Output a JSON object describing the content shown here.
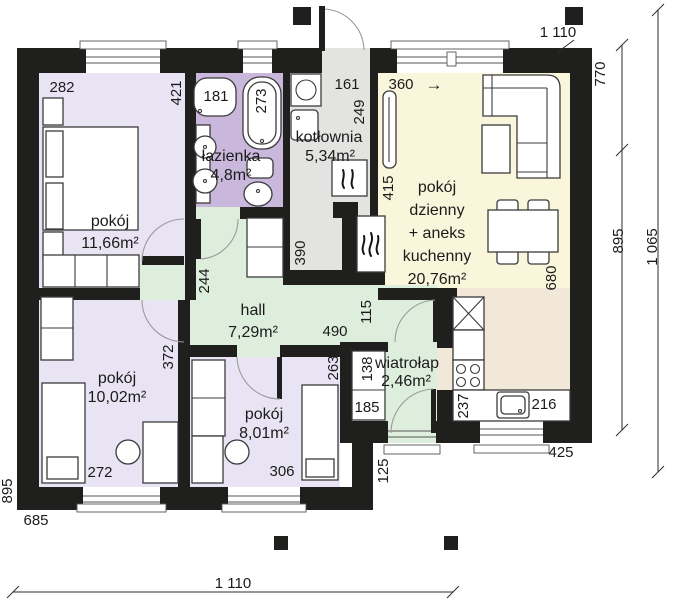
{
  "plan": {
    "rooms": {
      "pokoj1": {
        "label": "pokój",
        "area": "11,66m²"
      },
      "lazienka": {
        "label": "łazienka",
        "area": "4,8m²"
      },
      "kotlownia": {
        "label": "kotłownia",
        "area": "5,34m²"
      },
      "salon": {
        "line1": "pokój",
        "line2": "dzienny",
        "line3": "+ aneks",
        "line4": "kuchenny",
        "area": "20,76m²"
      },
      "hall": {
        "label": "hall",
        "area": "7,29m²"
      },
      "pokoj2": {
        "label": "pokój",
        "area": "10,02m²"
      },
      "pokoj3": {
        "label": "pokój",
        "area": "8,01m²"
      },
      "wiatrolap": {
        "label": "wiatrołap",
        "area": "2,46m²"
      }
    },
    "outer_dims": {
      "top": "1 110",
      "bottom": "1 110",
      "left": "895",
      "right_upper": "770",
      "right_lower": "895",
      "right_total": "1 065",
      "bottom_left": "685",
      "bottom_right": "425",
      "step": "125"
    },
    "inner_dims": {
      "d282": "282",
      "d421": "421",
      "d181": "181",
      "d273": "273",
      "d161": "161",
      "d249": "249",
      "d360": "360",
      "arrow": "→",
      "d415": "415",
      "d390": "390",
      "d244": "244",
      "d490": "490",
      "d115": "115",
      "d372": "372",
      "d263": "263",
      "d138": "138",
      "d185": "185",
      "d272": "272",
      "d306": "306",
      "d237": "237",
      "d216": "216",
      "d680": "680"
    },
    "colors": {
      "wall": "#1f1f1d",
      "room_lavender": "#e9e4f3",
      "bathroom_purple": "#c9b8dc",
      "utility_gray": "#e3e3e1",
      "living_cream": "#faf6dc",
      "hall_green": "#deeedd",
      "kitchen_beige": "#f2e8da"
    }
  }
}
